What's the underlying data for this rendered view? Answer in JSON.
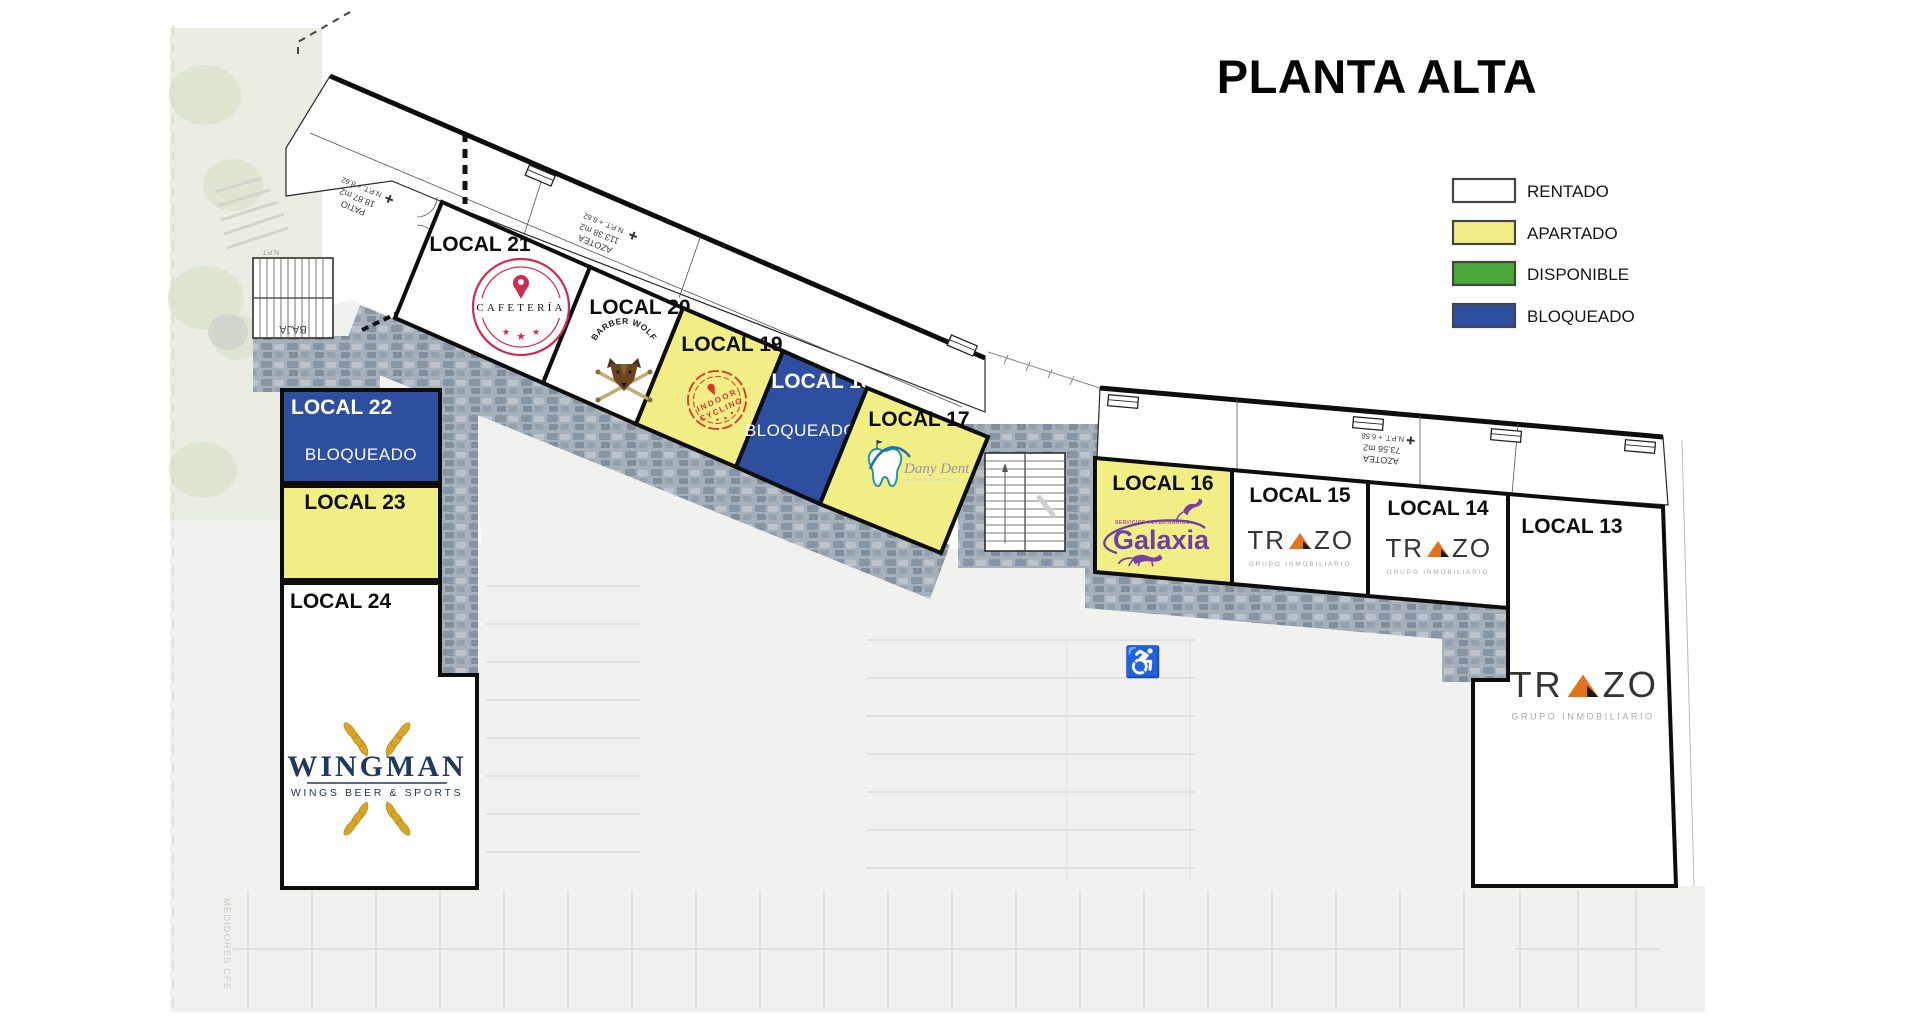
{
  "title": "PLANTA ALTA",
  "colors": {
    "rentado": "#ffffff",
    "apartado": "#f1ee86",
    "disponible": "#4aa838",
    "bloqueado": "#2e4e9f",
    "walkway_base": "#a6b0bb",
    "cafeteria_red": "#cf2b4e",
    "cycling_red": "#d9352a",
    "galaxia_purple": "#6b3fa5",
    "trazo_orange": "#e4711c",
    "wingman_navy": "#20395c",
    "wingman_gold": "#d9a522",
    "dent_teal": "#2794a8"
  },
  "legend": {
    "items": [
      {
        "label": "RENTADO",
        "color": "#ffffff"
      },
      {
        "label": "APARTADO",
        "color": "#f1ee86"
      },
      {
        "label": "DISPONIBLE",
        "color": "#4aa838"
      },
      {
        "label": "BLOQUEADO",
        "color": "#2e4e9f"
      }
    ]
  },
  "locals": [
    {
      "label": "LOCAL 21",
      "status": "RENTADO",
      "tenant": "Cafetería"
    },
    {
      "label": "LOCAL 20",
      "status": "RENTADO",
      "tenant": "Barber Wolf"
    },
    {
      "label": "LOCAL 19",
      "status": "APARTADO",
      "tenant": "Indoor Cycling"
    },
    {
      "label": "LOCAL 18",
      "status": "BLOQUEADO",
      "status_text": "BLOQUEADO"
    },
    {
      "label": "LOCAL 17",
      "status": "APARTADO",
      "tenant": "Dany Dent"
    },
    {
      "label": "LOCAL 16",
      "status": "APARTADO",
      "tenant": "Galaxia"
    },
    {
      "label": "LOCAL 15",
      "status": "RENTADO",
      "tenant": "Trazo"
    },
    {
      "label": "LOCAL 14",
      "status": "RENTADO",
      "tenant": "Trazo"
    },
    {
      "label": "LOCAL 13",
      "status": "RENTADO",
      "tenant": "Trazo"
    },
    {
      "label": "LOCAL 22",
      "status": "BLOQUEADO",
      "status_text": "BLOQUEADO"
    },
    {
      "label": "LOCAL 23",
      "status": "APARTADO"
    },
    {
      "label": "LOCAL 24",
      "status": "RENTADO",
      "tenant": "Wingman"
    }
  ],
  "annotations": {
    "patio": {
      "l1": "PATIO",
      "l2": "18.87 m2",
      "l3": "N.P.T. + 8.62"
    },
    "azotea_left": {
      "l1": "AZOTEA",
      "l2": "113.38 m2",
      "l3": "N.P.T. + 8.62"
    },
    "azotea_right": {
      "l1": "AZOTEA",
      "l2": "73.56 m2",
      "l3": "N.P.T. + 6.58"
    },
    "stairs_down": "BAJA",
    "npt_short": "N.P.T.",
    "meters": "MEDIDORES CFE"
  },
  "logos": {
    "cafeteria": {
      "name": "CAFETERÍA"
    },
    "barber_wolf": {
      "name": "BARBER WOLF"
    },
    "indoor_cycling": {
      "l1": "INDOOR",
      "l2": "CYCLING"
    },
    "dany_dent": {
      "name": "Dany Dent"
    },
    "galaxia": {
      "name": "Galaxia",
      "tagline": "SERVICIOS VETERINARIOS"
    },
    "trazo": {
      "tr": "TR",
      "zo": "ZO",
      "tagline": "GRUPO INMOBILIARIO"
    },
    "wingman": {
      "name": "WINGMAN",
      "tagline": "WINGS BEER & SPORTS"
    }
  },
  "icons": {
    "star": "★",
    "wheelchair": "♿"
  }
}
